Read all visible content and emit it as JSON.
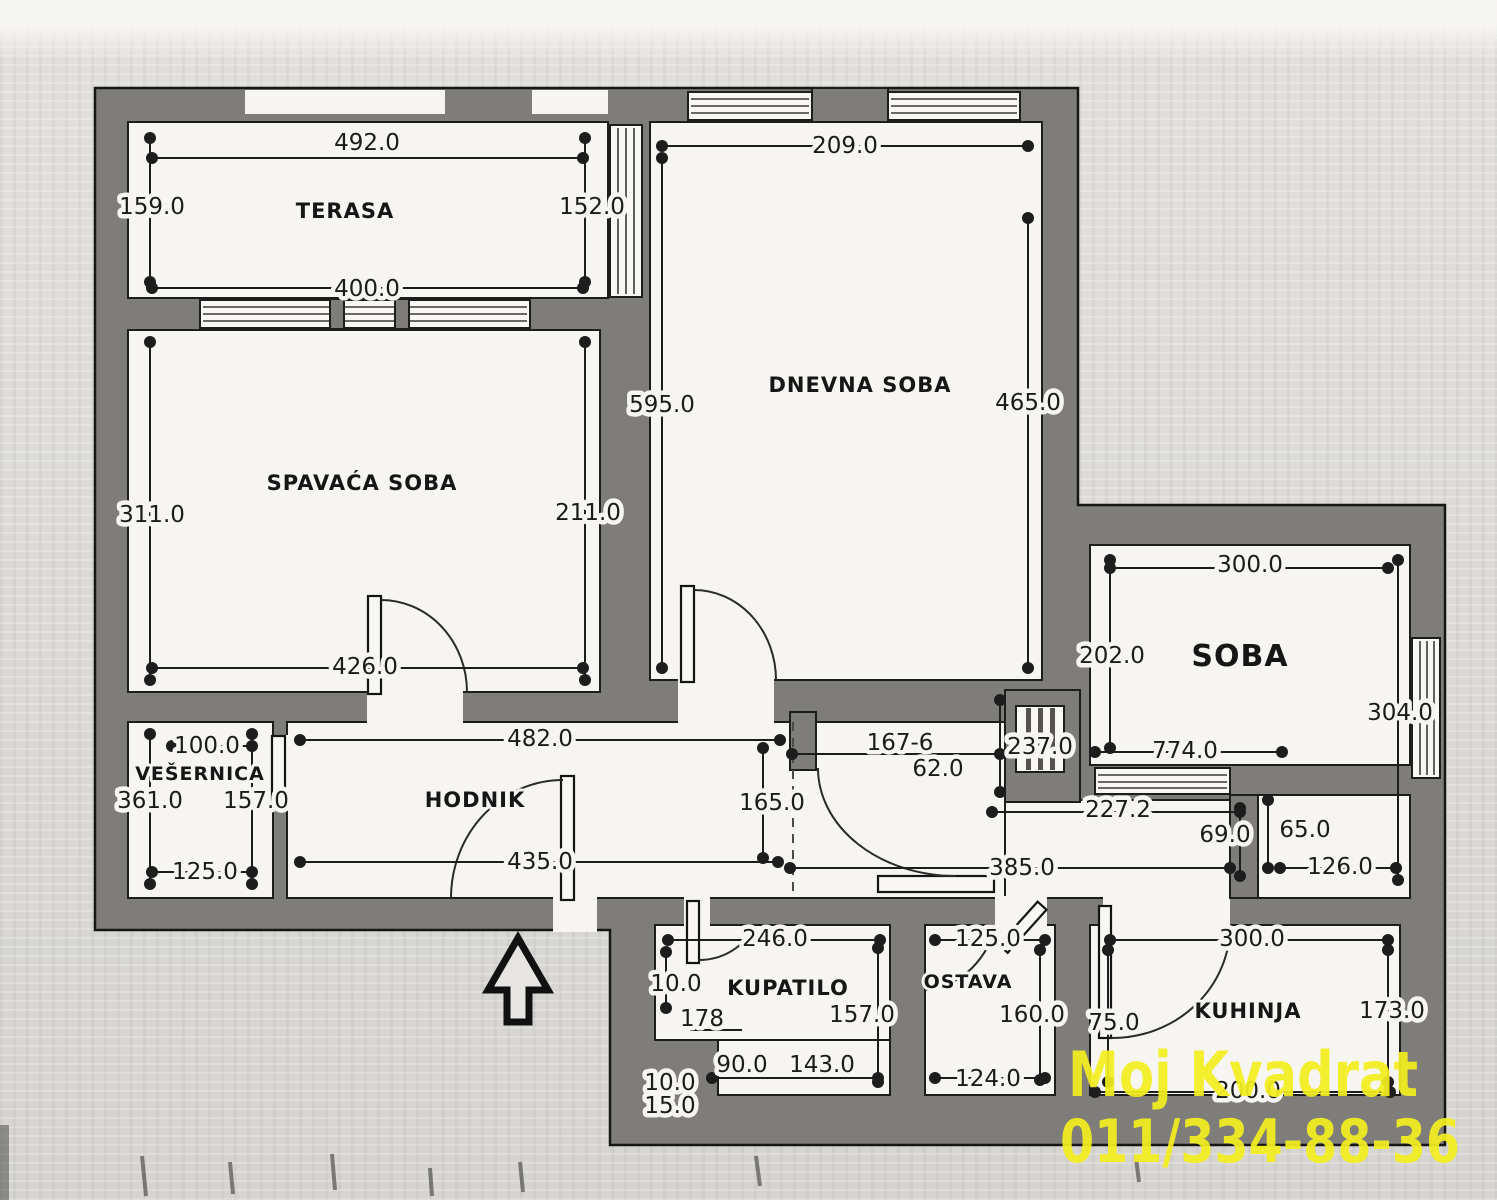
{
  "plan": {
    "rooms": {
      "terasa": {
        "label": "TERASA",
        "top": "492.0",
        "bottom": "400.0",
        "left": "159.0",
        "right": "152.0"
      },
      "dnevna_soba": {
        "label": "DNEVNA SOBA",
        "top": "209.0",
        "left": "595.0",
        "right": "465.0"
      },
      "spavaca_soba": {
        "label": "SPAVAĆA SOBA",
        "left": "311.0",
        "right": "211.0",
        "bottom": "426.0"
      },
      "soba": {
        "label": "SOBA",
        "top": "300.0",
        "left": "202.0",
        "right": "304.0",
        "bottom": "774.0"
      },
      "vesernica": {
        "label": "VEŠERNICA",
        "top": "100.0",
        "left": "361.0",
        "right": "157.0",
        "bottom": "125.0"
      },
      "hodnik": {
        "label": "HODNIK",
        "top": "482.0",
        "bottom": "435.0",
        "right": "165.0"
      },
      "kupatilo": {
        "label": "KUPATILO",
        "top": "246.0",
        "niche": "10.0",
        "door": "178",
        "right": "157.0",
        "bottom_left": "90.0",
        "bottom": "143.0"
      },
      "ostava": {
        "label": "OSTAVA",
        "top": "125.0",
        "right": "160.0",
        "bottom": "124.0"
      },
      "kuhinja": {
        "label": "KUHINJA",
        "top": "300.0",
        "left": "75.0",
        "right": "173.0",
        "bottom": "200.0"
      }
    },
    "hall": {
      "entry": "167-6",
      "offset": "62.0",
      "shaft": "237.0",
      "passage": "227.2",
      "stub": "69.0",
      "niche": "65.0",
      "niche_bottom": "126.0",
      "bottom": "385.0"
    },
    "exterior": {
      "dim_top": "10.0",
      "dim_bottom": "15.0"
    }
  },
  "watermark": {
    "line1": "Moj Kvadrat",
    "line2": "011/334-88-36"
  },
  "colors": {
    "wall": "#7f7d7a",
    "room_fill": "#f6f5f2",
    "paper": "#dcdad6",
    "line": "#1d1d1d",
    "watermark_yellow": "#f3ee20"
  }
}
